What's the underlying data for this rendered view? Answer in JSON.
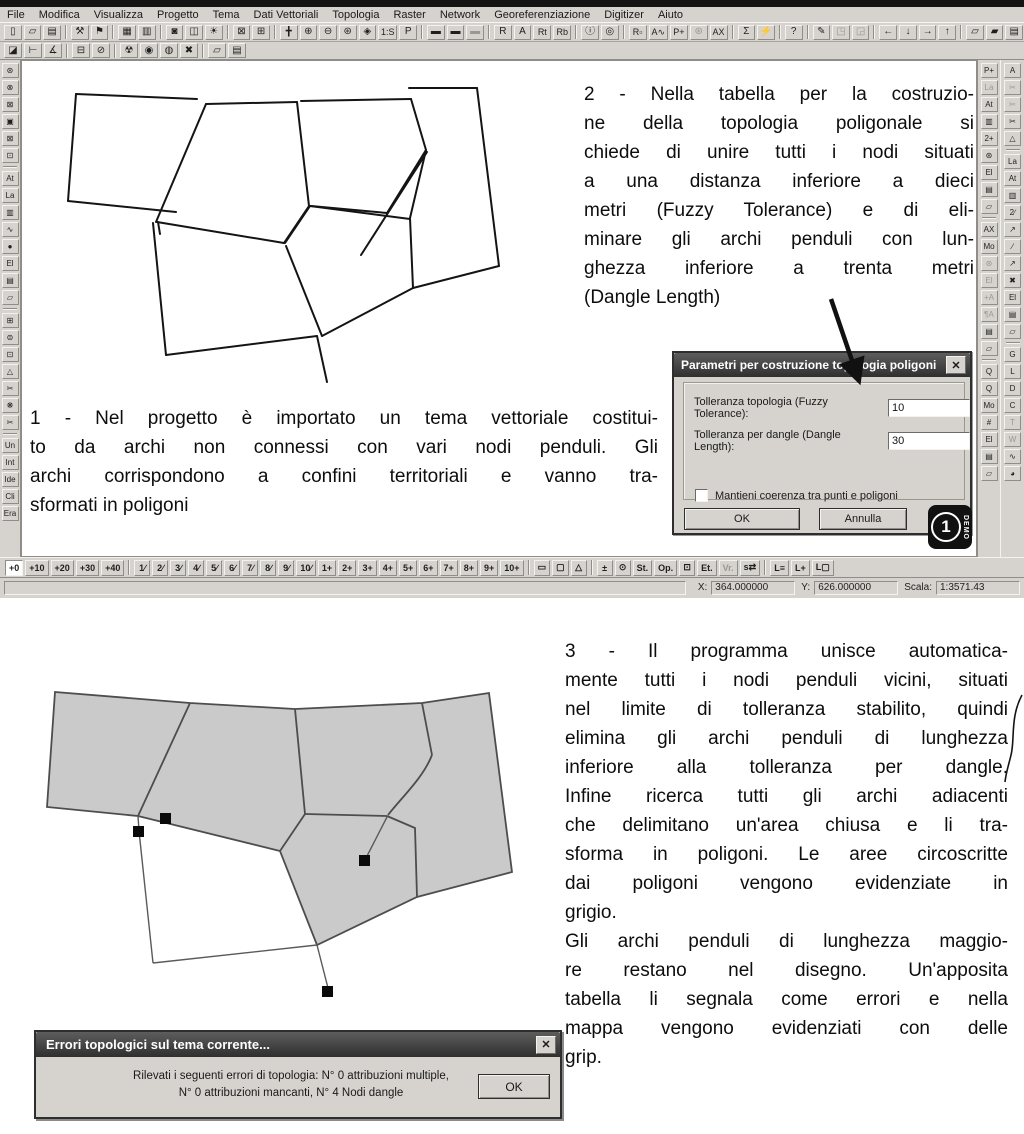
{
  "window": {
    "menu": [
      {
        "label": "File",
        "name": "menu-file"
      },
      {
        "label": "Modifica",
        "name": "menu-modifica"
      },
      {
        "label": "Visualizza",
        "name": "menu-visualizza"
      },
      {
        "label": "Progetto",
        "name": "menu-progetto"
      },
      {
        "label": "Tema",
        "name": "menu-tema"
      },
      {
        "label": "Dati Vettoriali",
        "name": "menu-dati-vettoriali"
      },
      {
        "label": "Topologia",
        "name": "menu-topologia"
      },
      {
        "label": "Raster",
        "name": "menu-raster"
      },
      {
        "label": "Network",
        "name": "menu-network"
      },
      {
        "label": "Georeferenziazione",
        "name": "menu-georeferenziazione"
      },
      {
        "label": "Digitizer",
        "name": "menu-digitizer"
      },
      {
        "label": "Aiuto",
        "name": "menu-aiuto"
      }
    ],
    "toolbar1": [
      {
        "glyph": "▯",
        "name": "new-project-icon"
      },
      {
        "glyph": "▱",
        "name": "open-project-icon"
      },
      {
        "glyph": "▤",
        "name": "save-project-icon"
      },
      {
        "sep": true
      },
      {
        "glyph": "⚒",
        "name": "tools-icon"
      },
      {
        "glyph": "⚑",
        "name": "run-icon"
      },
      {
        "sep": true
      },
      {
        "glyph": "▦",
        "name": "print-icon"
      },
      {
        "glyph": "▥",
        "name": "page-layout-icon"
      },
      {
        "sep": true
      },
      {
        "glyph": "◙",
        "name": "legend-icon"
      },
      {
        "glyph": "◫",
        "name": "dual-view-icon"
      },
      {
        "glyph": "☀",
        "name": "redraw-icon"
      },
      {
        "sep": true
      },
      {
        "glyph": "⊠",
        "name": "close-view-icon"
      },
      {
        "glyph": "⊞",
        "name": "new-view-icon"
      },
      {
        "sep": true
      },
      {
        "glyph": "╋",
        "name": "pan-icon"
      },
      {
        "glyph": "⊕",
        "name": "zoom-in-icon"
      },
      {
        "glyph": "⊖",
        "name": "zoom-out-icon"
      },
      {
        "glyph": "⊛",
        "name": "zoom-extents-icon"
      },
      {
        "glyph": "◈",
        "name": "zoom-window-icon"
      },
      {
        "glyph": "1:S",
        "name": "zoom-scale-icon",
        "wide": true
      },
      {
        "glyph": "P",
        "name": "zoom-previous-icon"
      },
      {
        "sep": true
      },
      {
        "glyph": "▬",
        "name": "theme-list-icon"
      },
      {
        "glyph": "▬",
        "name": "theme-copy-icon"
      },
      {
        "glyph": "▬",
        "name": "theme-paste-icon",
        "disabled": true
      },
      {
        "sep": true
      },
      {
        "glyph": "R",
        "name": "raster-tool-icon"
      },
      {
        "glyph": "A",
        "name": "arc-view-icon"
      },
      {
        "glyph": "Rt",
        "name": "raster-table-icon",
        "wide": true
      },
      {
        "glyph": "Rb",
        "name": "raster-bands-icon",
        "wide": true
      },
      {
        "sep": true
      },
      {
        "glyph": "ⓘ",
        "name": "info-icon"
      },
      {
        "glyph": "◎",
        "name": "find-icon"
      },
      {
        "sep": true
      },
      {
        "glyph": "R▫",
        "name": "select-raster-icon",
        "wide": true
      },
      {
        "glyph": "A∿",
        "name": "select-arc-icon",
        "wide": true
      },
      {
        "glyph": "P+",
        "name": "add-point-icon",
        "wide": true
      },
      {
        "glyph": "⊛",
        "name": "snap-tolerance-icon",
        "disabled": true
      },
      {
        "glyph": "AX",
        "name": "attribute-text-icon",
        "wide": true
      },
      {
        "sep": true
      },
      {
        "glyph": "Σ",
        "name": "statistics-icon"
      },
      {
        "glyph": "⚡",
        "name": "query-icon"
      },
      {
        "sep": true
      },
      {
        "glyph": "?",
        "name": "help-icon"
      },
      {
        "sep": true
      },
      {
        "glyph": "✎",
        "name": "digitize-icon"
      },
      {
        "glyph": "◳",
        "name": "frame-icon",
        "disabled": true
      },
      {
        "glyph": "◲",
        "name": "print-frame-icon",
        "disabled": true
      },
      {
        "sep": true
      },
      {
        "glyph": "←",
        "name": "pan-west-icon"
      },
      {
        "glyph": "↓",
        "name": "pan-south-icon"
      },
      {
        "glyph": "→",
        "name": "pan-east-icon"
      },
      {
        "glyph": "↑",
        "name": "pan-north-icon"
      },
      {
        "sep": true
      },
      {
        "glyph": "▱",
        "name": "export-view-icon"
      },
      {
        "glyph": "▰",
        "name": "copy-view-icon"
      },
      {
        "glyph": "▤",
        "name": "save-view-icon"
      }
    ],
    "toolbar2": [
      {
        "glyph": "◪",
        "name": "select-polygon-icon"
      },
      {
        "glyph": "⊢",
        "name": "square-tool-icon"
      },
      {
        "glyph": "∡",
        "name": "angle-tool-icon"
      },
      {
        "sep": true
      },
      {
        "glyph": "⊟",
        "name": "join-arcs-icon"
      },
      {
        "glyph": "⊘",
        "name": "remove-node-icon"
      },
      {
        "sep": true
      },
      {
        "glyph": "☢",
        "name": "build-topology-icon"
      },
      {
        "glyph": "◉",
        "name": "node-topology-icon"
      },
      {
        "glyph": "◍",
        "name": "check-dangle-icon"
      },
      {
        "glyph": "✖",
        "name": "clear-topology-icon"
      },
      {
        "sep": true
      },
      {
        "glyph": "▱",
        "name": "open-topology-icon"
      },
      {
        "glyph": "▤",
        "name": "save-topology-icon"
      }
    ],
    "left_toolbar": [
      {
        "glyph": "⊛",
        "name": "zoom-selected-icon"
      },
      {
        "glyph": "⊗",
        "name": "deselect-icon"
      },
      {
        "glyph": "⊠",
        "name": "delete-selection-icon"
      },
      {
        "glyph": "▣",
        "name": "copy-selection-icon"
      },
      {
        "glyph": "⊠",
        "name": "crop-icon"
      },
      {
        "glyph": "⊡",
        "name": "extent-box-icon"
      },
      {
        "sep": true
      },
      {
        "glyph": "At",
        "name": "attributes-icon"
      },
      {
        "glyph": "La",
        "name": "labels-icon"
      },
      {
        "glyph": "▥",
        "name": "measure-icon"
      },
      {
        "glyph": "∿",
        "name": "spline-icon"
      },
      {
        "glyph": "●",
        "name": "fill-style-icon"
      },
      {
        "glyph": "El",
        "name": "eliminate-icon"
      },
      {
        "glyph": "▤",
        "name": "save-theme-icon"
      },
      {
        "glyph": "▱",
        "name": "open-theme-icon"
      },
      {
        "sep": true
      },
      {
        "glyph": "⊞",
        "name": "merge-icon"
      },
      {
        "glyph": "⊜",
        "name": "balance-icon"
      },
      {
        "glyph": "⊡",
        "name": "bounds-icon"
      },
      {
        "glyph": "△",
        "name": "polygon-tool-icon"
      },
      {
        "glyph": "✂",
        "name": "split-arc-icon"
      },
      {
        "glyph": "❋",
        "name": "explode-icon"
      },
      {
        "glyph": "✂",
        "name": "trim-icon"
      },
      {
        "sep": true
      },
      {
        "glyph": "Un",
        "name": "union-icon"
      },
      {
        "glyph": "Int",
        "name": "intersect-icon"
      },
      {
        "glyph": "Ide",
        "name": "identity-icon"
      },
      {
        "glyph": "Cli",
        "name": "clip-icon"
      },
      {
        "glyph": "Era",
        "name": "erase-icon"
      }
    ],
    "right_toolbar_inner": [
      {
        "glyph": "P+",
        "name": "add-point-icon"
      },
      {
        "glyph": "La",
        "name": "point-label-icon",
        "disabled": true
      },
      {
        "glyph": "At",
        "name": "point-attributes-icon"
      },
      {
        "glyph": "▥",
        "name": "point-measure-icon"
      },
      {
        "glyph": "2+",
        "name": "double-point-icon"
      },
      {
        "glyph": "⊛",
        "name": "point-snap-icon"
      },
      {
        "glyph": "El",
        "name": "point-delete-icon"
      },
      {
        "glyph": "▤",
        "name": "point-save-icon"
      },
      {
        "glyph": "▱",
        "name": "point-open-icon"
      },
      {
        "sep": true
      },
      {
        "glyph": "AX",
        "name": "text-tool-icon"
      },
      {
        "glyph": "Mo",
        "name": "modify-text-icon"
      },
      {
        "glyph": "⊛",
        "name": "text-snap-icon",
        "disabled": true
      },
      {
        "glyph": "El",
        "name": "text-delete-icon",
        "disabled": true
      },
      {
        "glyph": "+A",
        "name": "insert-text-icon",
        "disabled": true
      },
      {
        "glyph": "¶A",
        "name": "paragraph-text-icon",
        "disabled": true
      },
      {
        "glyph": "▤",
        "name": "text-save-icon"
      },
      {
        "glyph": "▱",
        "name": "text-open-icon"
      },
      {
        "sep": true
      },
      {
        "glyph": "Q",
        "name": "query-rect-icon"
      },
      {
        "glyph": "Q",
        "name": "query-zoom-icon"
      },
      {
        "glyph": "Mo",
        "name": "modify-query-icon"
      },
      {
        "glyph": "#",
        "name": "grid-icon"
      },
      {
        "glyph": "El",
        "name": "query-delete-icon"
      },
      {
        "glyph": "▤",
        "name": "query-save-icon"
      },
      {
        "glyph": "▱",
        "name": "query-open-icon"
      }
    ],
    "right_toolbar_outer": [
      {
        "glyph": "A",
        "name": "arc-edit-icon"
      },
      {
        "glyph": "✂",
        "name": "cut-node-icon",
        "disabled": true
      },
      {
        "glyph": "✂",
        "name": "cut-arc-icon",
        "disabled": true
      },
      {
        "glyph": "✂",
        "name": "scissors-icon"
      },
      {
        "glyph": "△",
        "name": "close-polygon-icon"
      },
      {
        "sep": true
      },
      {
        "glyph": "La",
        "name": "arc-label-icon"
      },
      {
        "glyph": "At",
        "name": "arc-attributes-icon"
      },
      {
        "glyph": "▥",
        "name": "arc-measure-icon"
      },
      {
        "glyph": "2∕",
        "name": "double-arc-icon"
      },
      {
        "glyph": "↗",
        "name": "direction-icon"
      },
      {
        "glyph": "∕",
        "name": "segment-icon"
      },
      {
        "glyph": "↗",
        "name": "vertex-move-icon"
      },
      {
        "glyph": "✖",
        "name": "delete-node-icon"
      },
      {
        "glyph": "El",
        "name": "arc-delete-icon"
      },
      {
        "glyph": "▤",
        "name": "arc-save-icon"
      },
      {
        "glyph": "▱",
        "name": "arc-open-icon"
      },
      {
        "sep": true
      },
      {
        "glyph": "G",
        "name": "georeference-icon"
      },
      {
        "glyph": "L",
        "name": "layers-icon"
      },
      {
        "glyph": "D",
        "name": "digitizer-icon"
      },
      {
        "glyph": "C",
        "name": "coordinates-icon"
      },
      {
        "glyph": "T",
        "name": "text-mode-icon",
        "disabled": true
      },
      {
        "glyph": "W",
        "name": "wms-icon",
        "disabled": true
      },
      {
        "glyph": "∿",
        "name": "profile-icon"
      },
      {
        "glyph": "◕",
        "name": "world-icon"
      }
    ],
    "bottom_toolbar": [
      {
        "label": "+0",
        "name": "tolerance-0-button",
        "active": true
      },
      {
        "label": "+10",
        "name": "tolerance-10-button"
      },
      {
        "label": "+20",
        "name": "tolerance-20-button"
      },
      {
        "label": "+30",
        "name": "tolerance-30-button"
      },
      {
        "label": "+40",
        "name": "tolerance-40-button"
      },
      {
        "sep": true
      },
      {
        "label": "1∕",
        "name": "scale-1-button"
      },
      {
        "label": "2∕",
        "name": "scale-2-button"
      },
      {
        "label": "3∕",
        "name": "scale-3-button"
      },
      {
        "label": "4∕",
        "name": "scale-4-button"
      },
      {
        "label": "5∕",
        "name": "scale-5-button"
      },
      {
        "label": "6∕",
        "name": "scale-6-button"
      },
      {
        "label": "7∕",
        "name": "scale-7-button"
      },
      {
        "label": "8∕",
        "name": "scale-8-button"
      },
      {
        "label": "9∕",
        "name": "scale-9-button"
      },
      {
        "label": "10∕",
        "name": "scale-10-button"
      },
      {
        "label": "1+",
        "name": "snap-1-button"
      },
      {
        "label": "2+",
        "name": "snap-2-button"
      },
      {
        "label": "3+",
        "name": "snap-3-button"
      },
      {
        "label": "4+",
        "name": "snap-4-button"
      },
      {
        "label": "5+",
        "name": "snap-5-button"
      },
      {
        "label": "6+",
        "name": "snap-6-button"
      },
      {
        "label": "7+",
        "name": "snap-7-button"
      },
      {
        "label": "8+",
        "name": "snap-8-button"
      },
      {
        "label": "9+",
        "name": "snap-9-button"
      },
      {
        "label": "10+",
        "name": "snap-10-button"
      },
      {
        "sep": true
      },
      {
        "label": "▭",
        "name": "measure-bar-icon"
      },
      {
        "label": "▢",
        "name": "rect-icon"
      },
      {
        "label": "△",
        "name": "polygon-icon"
      },
      {
        "sep": true
      },
      {
        "label": "±",
        "name": "offset-icon"
      },
      {
        "label": "⊙",
        "name": "lock-icon"
      },
      {
        "label": "St.",
        "name": "style-button"
      },
      {
        "label": "Op.",
        "name": "options-button"
      },
      {
        "label": "⊡",
        "name": "frame-toggle-icon"
      },
      {
        "label": "Et.",
        "name": "labels-toggle-button"
      },
      {
        "label": "Vr.",
        "name": "vertices-toggle-button",
        "disabled": true
      },
      {
        "label": "s⇄",
        "name": "swap-button"
      },
      {
        "sep": true
      },
      {
        "label": "L≡",
        "name": "layer-list-button"
      },
      {
        "label": "L+",
        "name": "layer-add-button"
      },
      {
        "label": "L▢",
        "name": "layer-box-button"
      }
    ],
    "status": {
      "x_label": "X:",
      "x_value": "364.000000",
      "y_label": "Y:",
      "y_value": "626.000000",
      "scale_label": "Scala:",
      "scale_value": "1:3571.43"
    }
  },
  "annotations": {
    "step1_lines": [
      "1 - Nel progetto è importato un tema vettoriale costitui-",
      "to da archi non connessi con vari nodi penduli. Gli",
      "archi corrispondono a confini territoriali e vanno tra-",
      "sformati in poligoni"
    ],
    "step2_lines": [
      "2 - Nella tabella per la costruzio-",
      "ne della topologia poligonale si",
      "chiede di unire tutti i nodi situati",
      "a una distanza inferiore a dieci",
      "metri (Fuzzy Tolerance) e di eli-",
      "minare gli archi penduli con lun-",
      "ghezza inferiore a trenta metri",
      "(Dangle Length)"
    ],
    "step3_para1": [
      "3 - Il programma unisce automatica-",
      "mente tutti i nodi penduli vicini, situati",
      "nel limite di tolleranza stabilito, quindi",
      "elimina gli archi penduli  di lunghezza",
      "inferiore alla tolleranza per dangle.",
      "Infine  ricerca tutti gli archi adiacenti",
      "che delimitano un'area chiusa e li tra-",
      "sforma in poligoni. Le aree circoscritte",
      "dai poligoni vengono evidenziate in",
      "grigio."
    ],
    "step3_para2": [
      "Gli archi penduli di lunghezza maggio-",
      "re restano nel disegno. Un'apposita",
      "tabella li segnala come errori e nella",
      "mappa vengono evidenziati con delle",
      "grip."
    ]
  },
  "params_dialog": {
    "title": "Parametri per costruzione topologia poligoni",
    "close_glyph": "✕",
    "fuzzy_label": "Tolleranza topologia (Fuzzy Tolerance):",
    "fuzzy_value": "10",
    "dangle_label": "Tolleranza per dangle (Dangle Length):",
    "dangle_value": "30",
    "checkbox_label": "Mantieni coerenza tra punti e poligoni",
    "ok_label": "OK",
    "cancel_label": "Annulla",
    "demo_number": "1",
    "demo_text": "DEMO"
  },
  "error_dialog": {
    "title": "Errori topologici sul tema corrente...",
    "close_glyph": "✕",
    "line1": "Rilevati i seguenti errori di topologia:  N° 0 attribuzioni multiple,",
    "line2": "N° 0 attribuzioni mancanti,   N° 4 Nodi dangle",
    "ok_label": "OK"
  },
  "colors": {
    "chrome": "#d6d3ce",
    "title_dark": "#3a3a3a",
    "polygon_fill": "#cacaca",
    "line": "#141414"
  }
}
